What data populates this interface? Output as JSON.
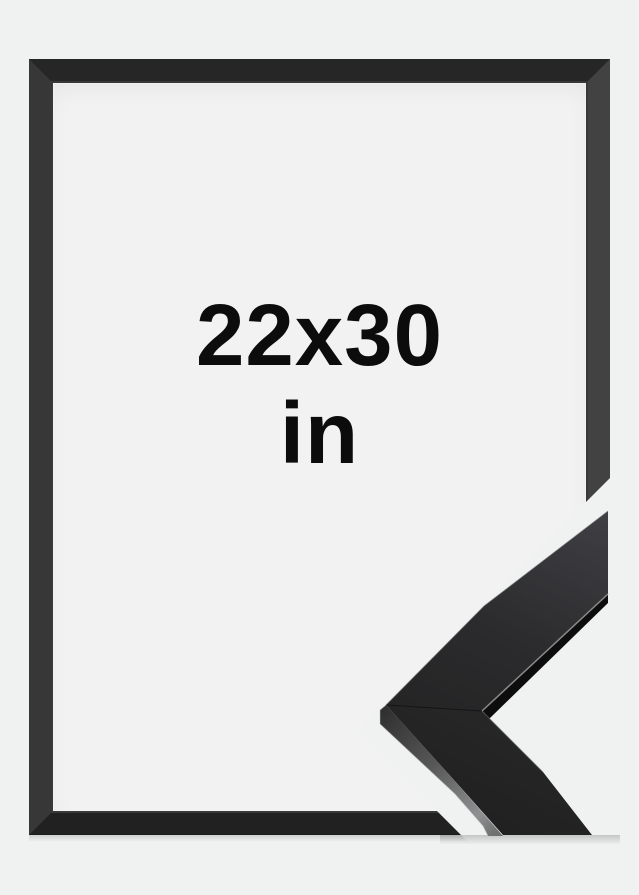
{
  "product_image": {
    "size_label": "22x30",
    "unit_label": "in"
  },
  "colors": {
    "background": "#f0f1f1",
    "frame_opening": "#f2f2f3",
    "frame_border_top": "#262626",
    "frame_border_right": "#424242",
    "frame_border_bottom": "#212121",
    "frame_border_left": "#373737",
    "text": "#0c0c0c",
    "moulding_surface": "#2b2b2b",
    "moulding_inner_face": "#0d0d0d"
  }
}
